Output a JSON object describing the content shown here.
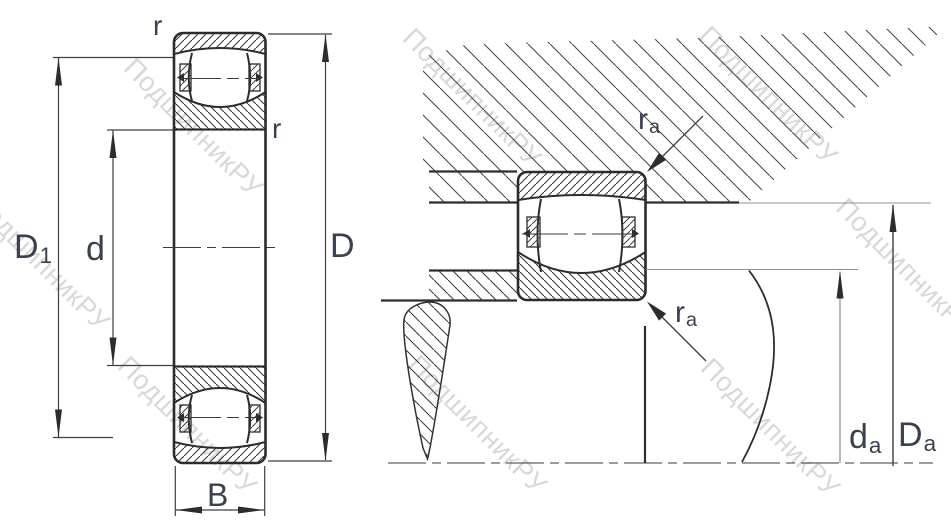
{
  "drawing": {
    "description": "spherical roller bearing cross-section and mounting dimensions",
    "watermark": {
      "text": "ПодшипникРУ"
    },
    "front_view": {
      "labels": {
        "corner_radius_top": {
          "main": "r"
        },
        "corner_radius_inner": {
          "main": "r"
        },
        "outer_diameter": {
          "main": "D"
        },
        "shoulder_diameter": {
          "main": "D",
          "sub": "1"
        },
        "bore_diameter": {
          "main": "d"
        },
        "width": {
          "main": "B"
        }
      }
    },
    "mounting_view": {
      "labels": {
        "housing_fillet_radius": {
          "main": "r",
          "sub": "a"
        },
        "shaft_fillet_radius": {
          "main": "r",
          "sub": "a"
        },
        "shaft_shoulder_diameter": {
          "main": "d",
          "sub": "a"
        },
        "housing_shoulder_diameter": {
          "main": "D",
          "sub": "a"
        }
      }
    },
    "colors": {
      "line": "#2d2d2d",
      "label": "#39404e",
      "watermark": "#bcbcbc",
      "background": "#ffffff"
    }
  }
}
